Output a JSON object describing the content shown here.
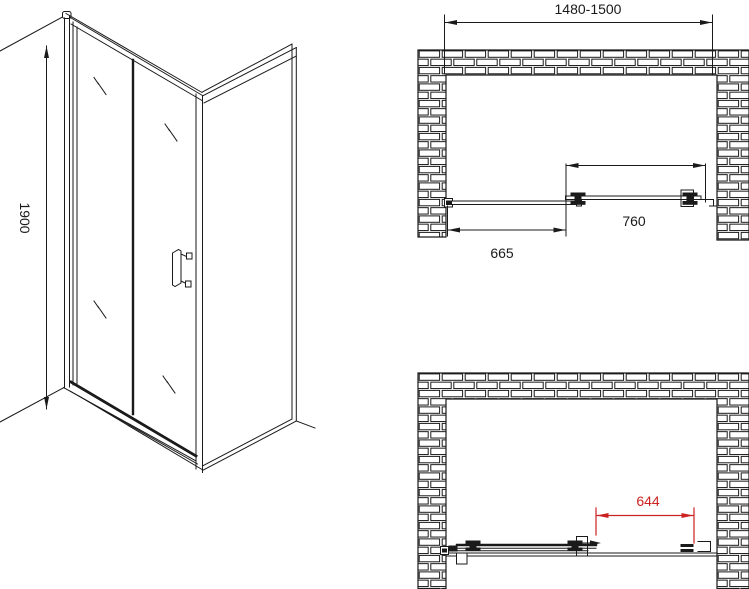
{
  "drawing": {
    "background": "#ffffff",
    "line_color": "#1a1a1a",
    "accent_red": "#cc2222",
    "isometric_view": {
      "height_dimension": "1900"
    },
    "plan_view_closed": {
      "overall_width_dimension": "1480-1500",
      "fixed_panel_dimension": "665",
      "sliding_door_dimension": "760"
    },
    "plan_view_open": {
      "clear_opening_dimension": "644"
    }
  }
}
